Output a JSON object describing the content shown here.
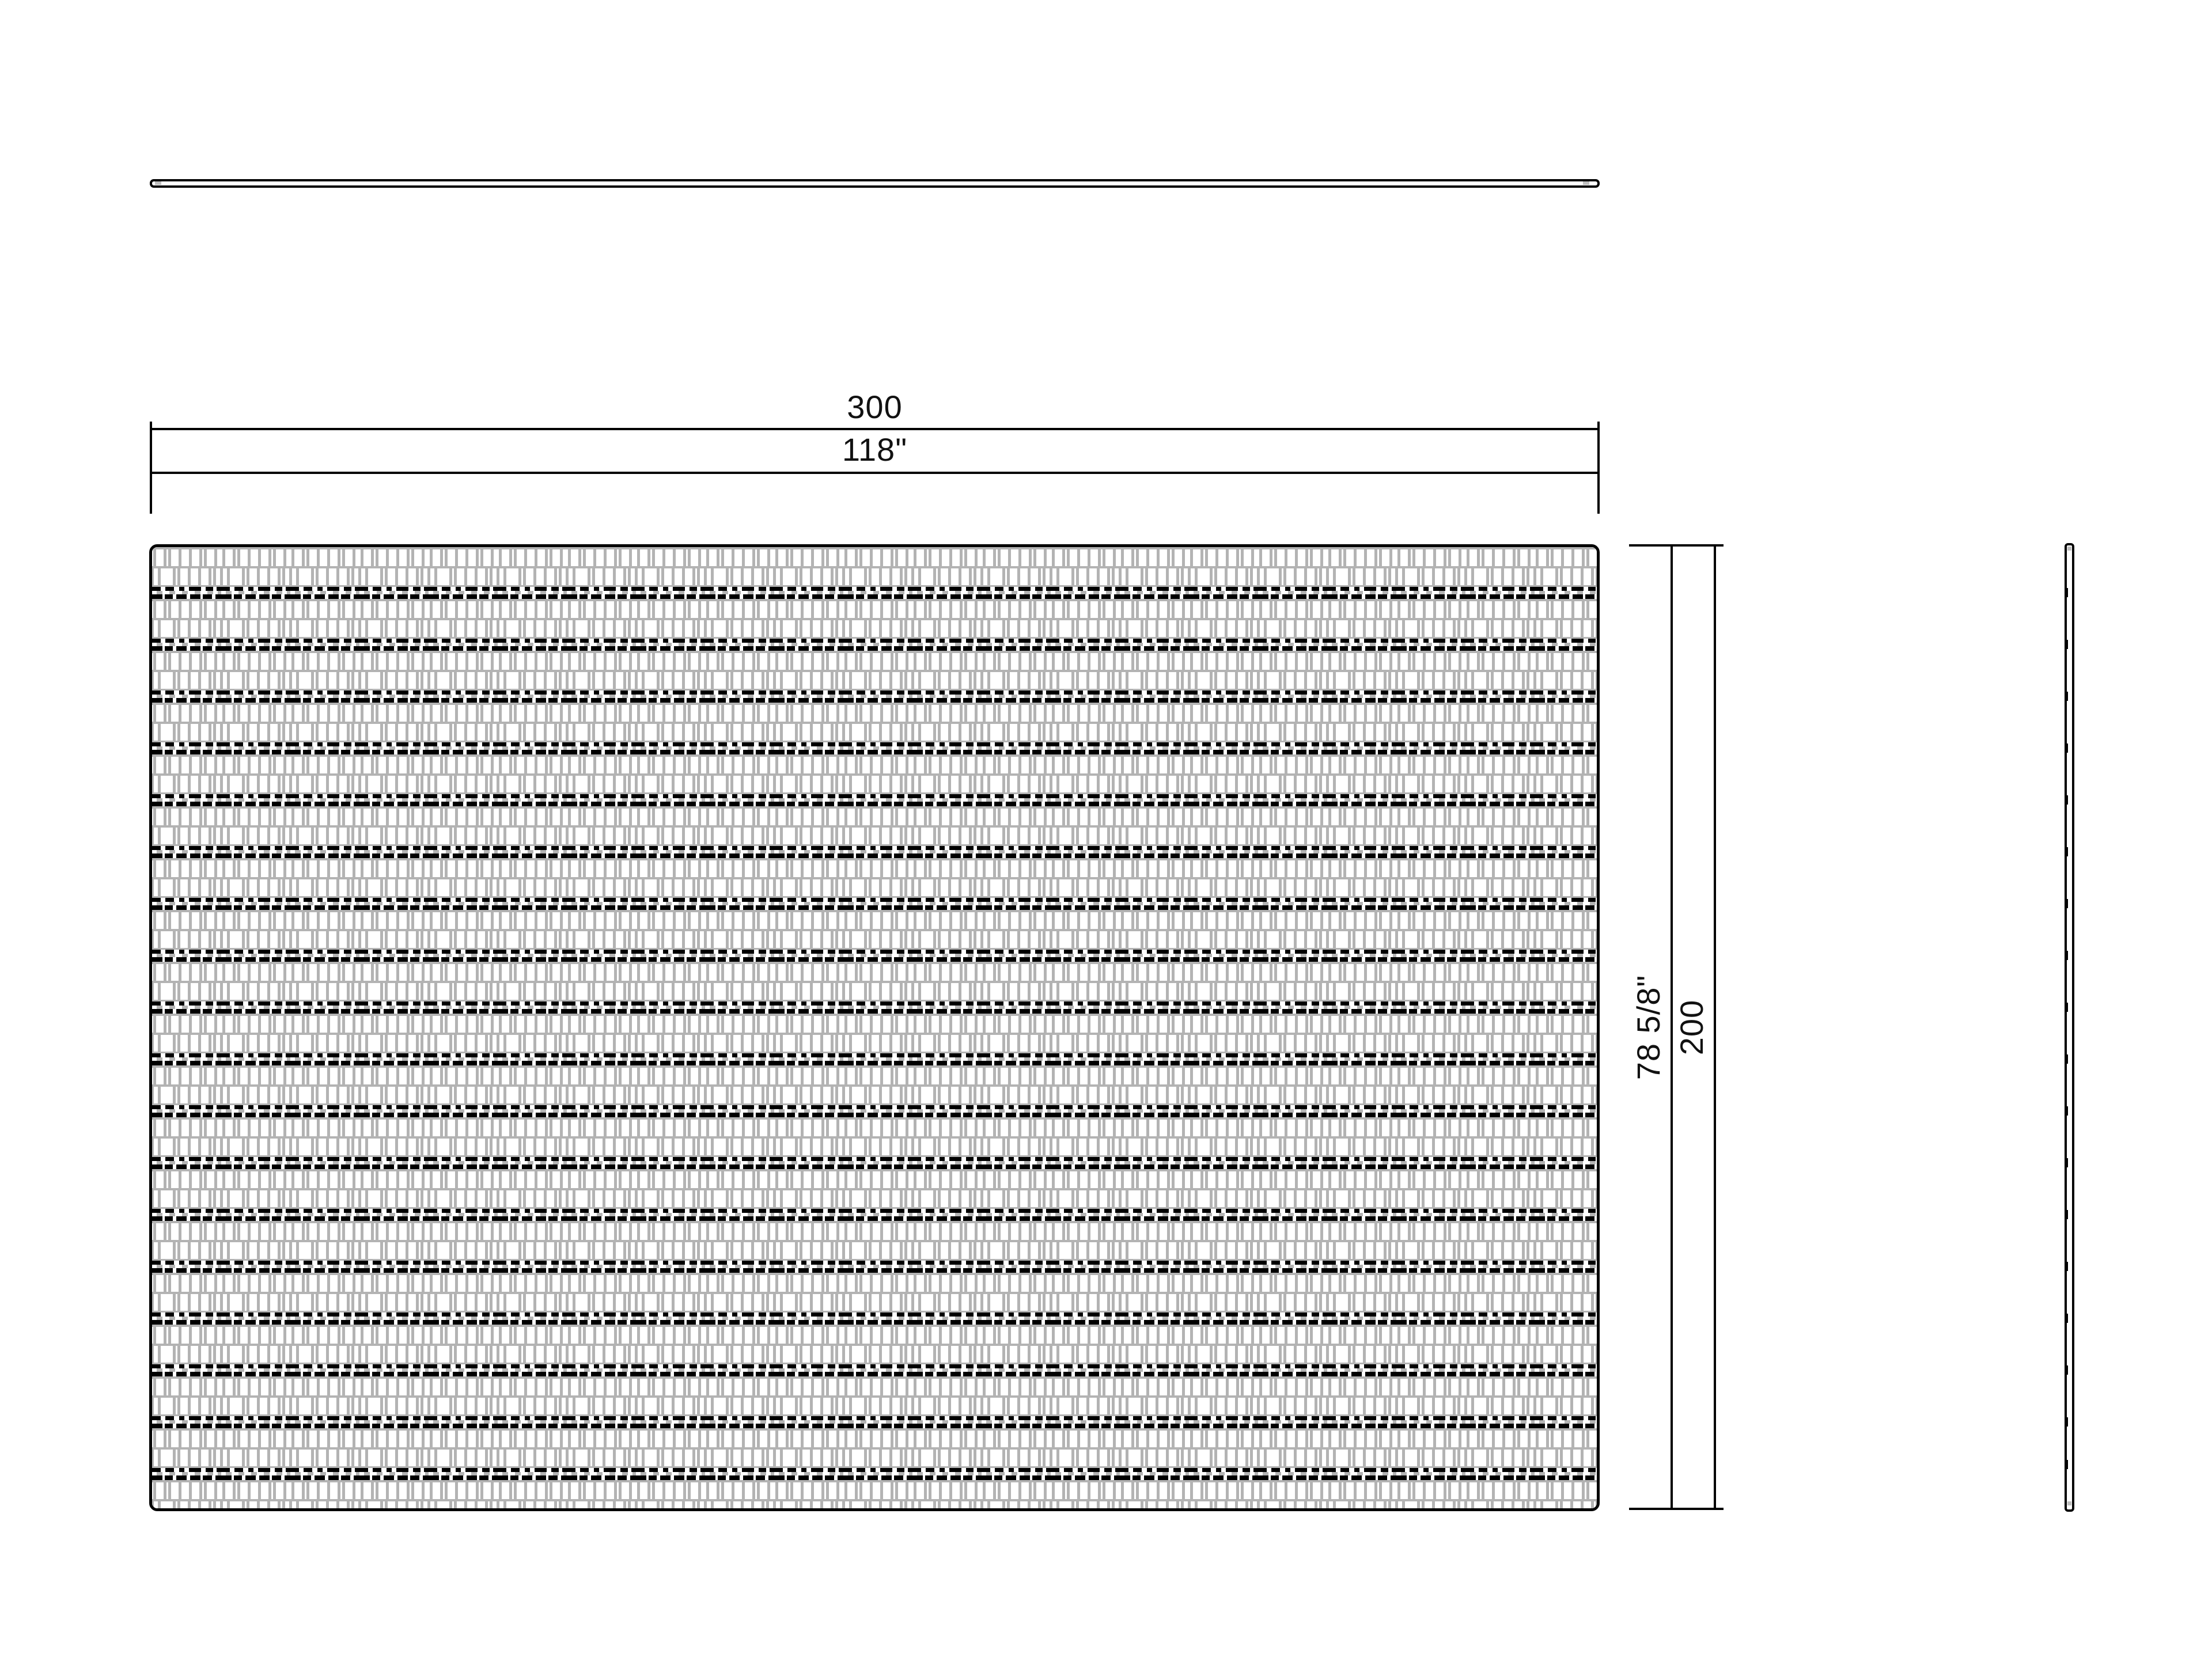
{
  "drawing": {
    "type": "rug-technical-drawing",
    "colors": {
      "line": "#000000",
      "texture_gray": "#b3b3b3",
      "background": "#ffffff"
    },
    "dimensions": {
      "width_cm": "300",
      "width_in": "118\"",
      "height_in": "78 5/8\"",
      "height_cm": "200"
    }
  }
}
